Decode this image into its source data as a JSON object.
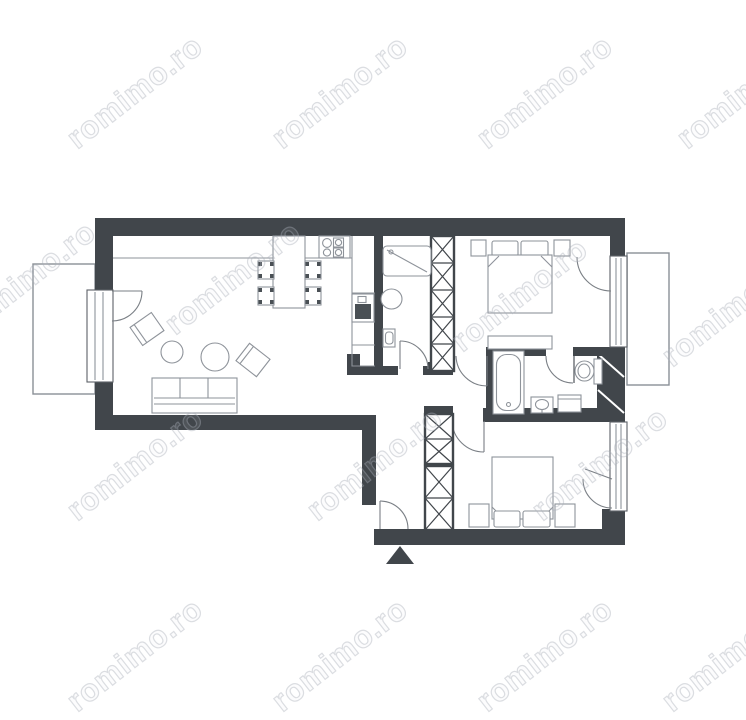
{
  "watermark": {
    "text": "romimo.ro"
  },
  "colors": {
    "wall": "#41464b",
    "furniture": "#8e939a",
    "thin": "#5d6268",
    "door": "#7a7f85",
    "balcony": "#8a9096",
    "fixture-dark": "#4a5055",
    "watermark": "#aab0ba",
    "background": "#ffffff"
  },
  "plan": {
    "type": "apartment-floor-plan",
    "icons": {
      "entrance-marker": "triangle-up",
      "wardrobe-column": "x-hatched-box",
      "door": "quarter-arc",
      "shaft": "diagonal-hatched-block"
    }
  }
}
